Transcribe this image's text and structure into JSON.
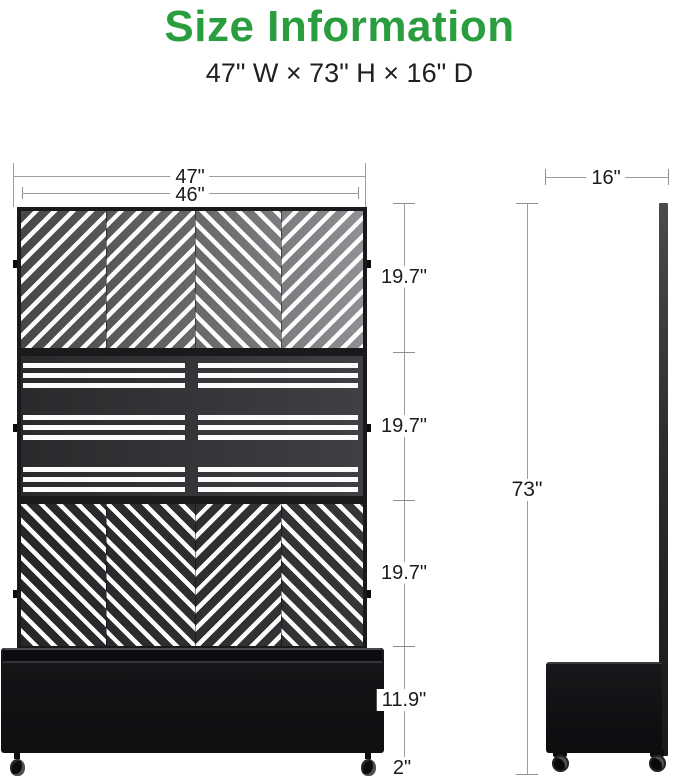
{
  "title": {
    "text": "Size Information"
  },
  "subtitle": "47\" W × 73\" H × 16\" D",
  "front_view": {
    "total_width": "47\"",
    "panel_width": "46\"",
    "height_segments": [
      "19.7\"",
      "19.7\"",
      "19.7\"",
      "11.9\"",
      "2\""
    ]
  },
  "side_view": {
    "depth": "16\"",
    "height": "73\""
  },
  "colors": {
    "accent_green": "#2a9d3f",
    "panel_frame": "#191a1c",
    "panel_gray_light": "#909094",
    "panel_gray_dark": "#27272a",
    "planter_black": "#131316",
    "dimension_line": "#9e9ea1",
    "text": "#1c1c1c",
    "slat_white": "#fcfcfc"
  }
}
